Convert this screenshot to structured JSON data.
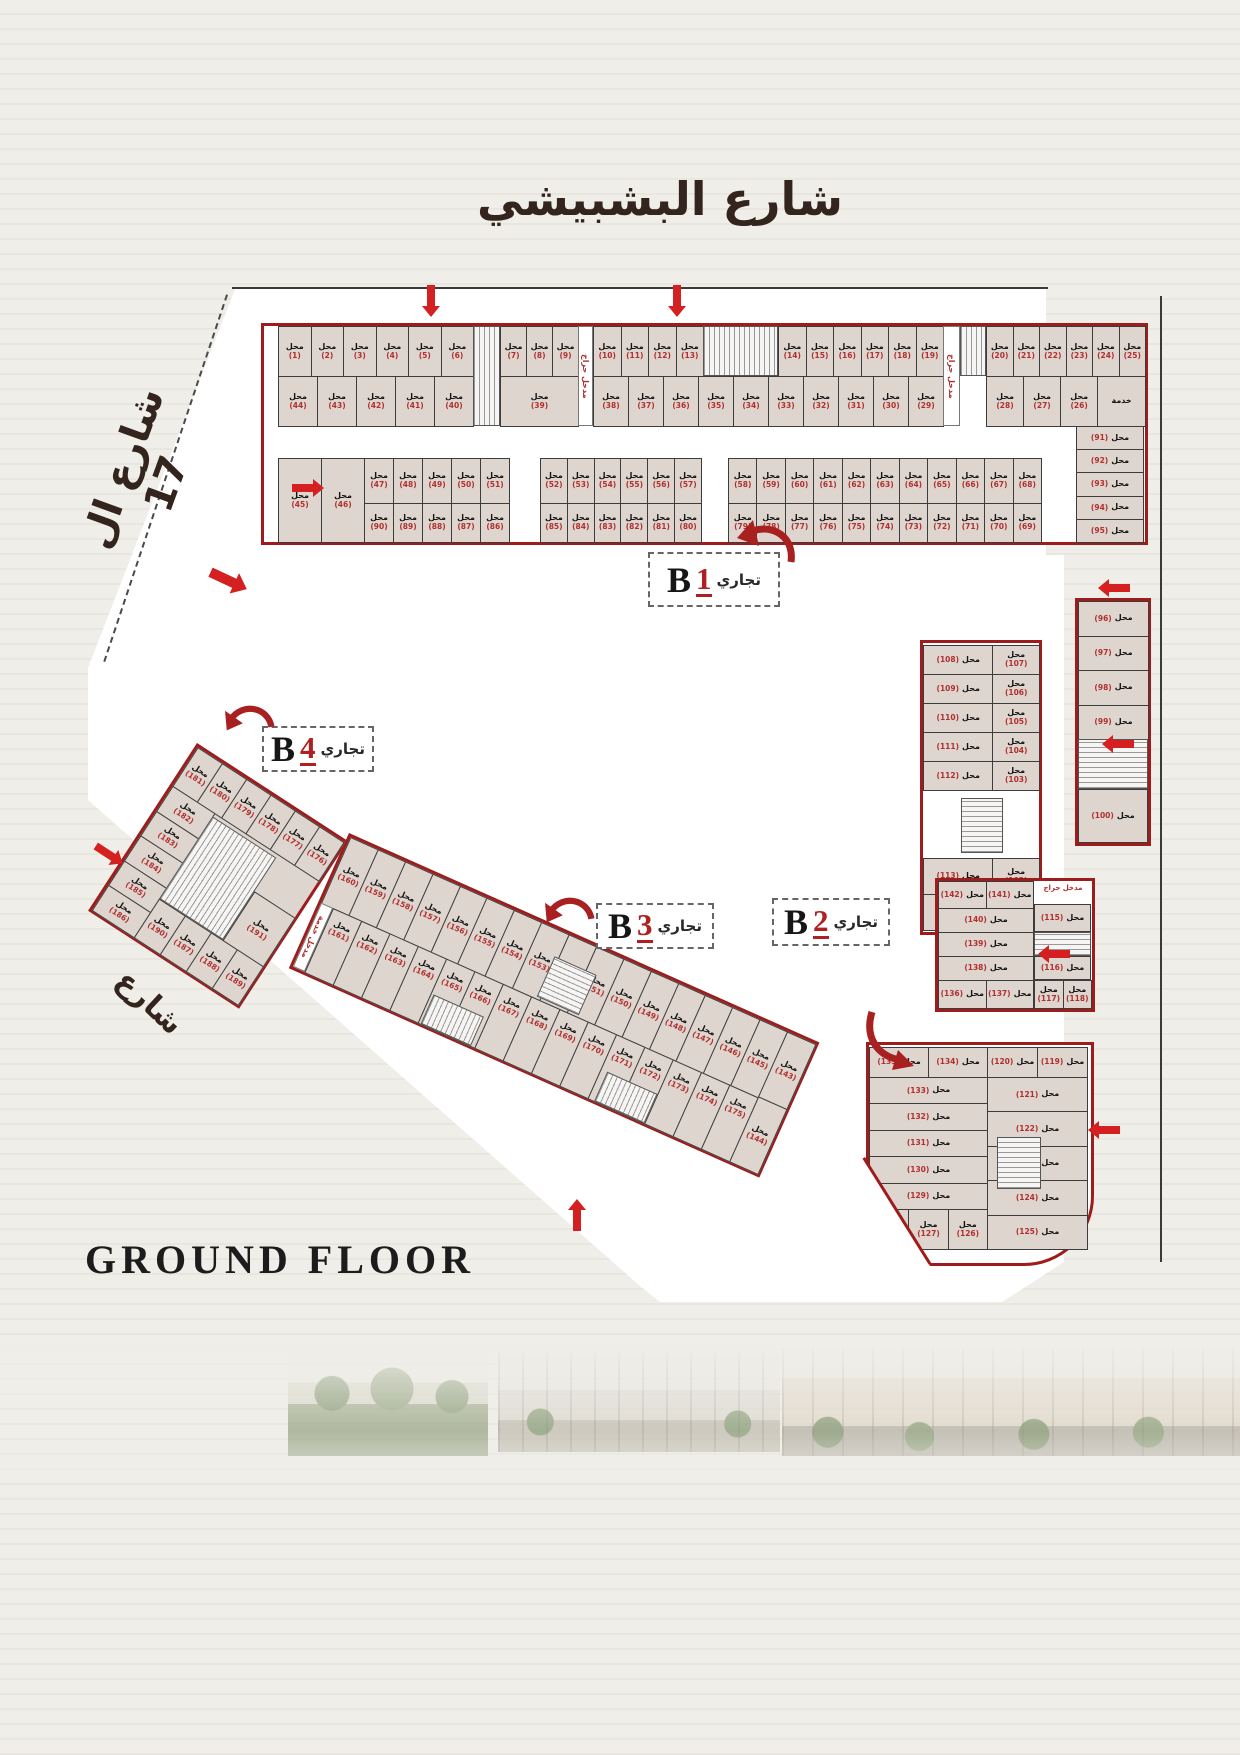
{
  "labels": {
    "shop": "محل",
    "service": "خدمة",
    "commercial": "تجاري",
    "ground_floor": "GROUND FLOOR"
  },
  "streets": {
    "top": "شارع  البشبيشي",
    "left": "شارع ال 17",
    "left_lower": "شارع",
    "right": "شارع"
  },
  "entrances": {
    "garage": "مدخل جراج",
    "service_entrance": "مدخل خدمة"
  },
  "blocks": {
    "b1": {
      "letter": "B",
      "number": "1",
      "a1": [
        "(1)",
        "(2)",
        "(3)",
        "(4)",
        "(5)",
        "(6)"
      ],
      "a2": [
        "(7)",
        "(8)",
        "(9)"
      ],
      "a3": [
        "(10)",
        "(11)",
        "(12)",
        "(13)"
      ],
      "a4": [
        "(14)",
        "(15)",
        "(16)",
        "(17)",
        "(18)",
        "(19)"
      ],
      "a5": [
        "(20)",
        "(21)",
        "(22)",
        "(23)",
        "(24)",
        "(25)"
      ],
      "bb1": [
        "(44)",
        "(43)",
        "(42)",
        "(41)",
        "(40)"
      ],
      "bb2": [
        "(39)"
      ],
      "bb3": [
        "(38)",
        "(37)",
        "(36)",
        "(35)",
        "(34)",
        "(33)",
        "(32)",
        "(31)",
        "(30)",
        "(29)"
      ],
      "bb4": [
        "(28)",
        "(27)",
        "(26)"
      ],
      "c1": [
        "(45)",
        "(46)"
      ],
      "c2": [
        "(47)",
        "(48)",
        "(49)",
        "(50)",
        "(51)"
      ],
      "c3": [
        "(52)",
        "(53)",
        "(54)",
        "(55)",
        "(56)",
        "(57)"
      ],
      "c4": [
        "(58)",
        "(59)",
        "(60)",
        "(61)",
        "(62)",
        "(63)",
        "(64)",
        "(65)",
        "(66)",
        "(67)",
        "(68)"
      ],
      "d1": [
        "(90)",
        "(89)",
        "(88)",
        "(87)",
        "(86)"
      ],
      "d2": [
        "(85)",
        "(84)",
        "(83)",
        "(82)",
        "(81)",
        "(80)"
      ],
      "d3": [
        "(79)",
        "(78)",
        "(77)",
        "(76)",
        "(75)",
        "(74)",
        "(73)",
        "(72)",
        "(71)",
        "(70)",
        "(69)"
      ],
      "col91": [
        "(91)",
        "(92)",
        "(93)",
        "(94)",
        "(95)"
      ],
      "col96": [
        "(96)",
        "(97)",
        "(98)",
        "(99)"
      ],
      "cell100": "(100)",
      "mr1": [
        [
          "(108)",
          "(107)"
        ],
        [
          "(109)",
          "(106)"
        ],
        [
          "(110)",
          "(105)"
        ],
        [
          "(111)",
          "(104)"
        ],
        [
          "(112)",
          "(103)"
        ]
      ],
      "mr2": [
        [
          "(113)",
          "(102)"
        ],
        [
          "(114)",
          "(101)"
        ]
      ]
    },
    "b2": {
      "letter": "B",
      "number": "2",
      "t_left_pair": [
        [
          "(142)",
          "(141)"
        ]
      ],
      "t_left_singles": [
        "(140)",
        "(139)",
        "(138)"
      ],
      "t_left_pair2": [
        [
          "(136)",
          "(137)"
        ]
      ],
      "t_right_single1": "(115)",
      "t_right_single2": "(116)",
      "t_right_pair": [
        [
          "(117)",
          "(118)"
        ]
      ],
      "b_left_pair": [
        [
          "(135)",
          "(134)"
        ]
      ],
      "b_left_singles": [
        "(133)",
        "(132)",
        "(131)",
        "(130)",
        "(129)"
      ],
      "b_left_bottom": [
        "(128)",
        "(127)",
        "(126)"
      ],
      "b_right_pair": [
        [
          "(120)",
          "(119)"
        ]
      ],
      "b_right_singles": [
        "(121)",
        "(122)",
        "(123)",
        "(124)",
        "(125)"
      ]
    },
    "b3": {
      "letter": "B",
      "number": "3",
      "row1": [
        "(160)",
        "(159)",
        "(158)",
        "(157)",
        "(156)",
        "(155)",
        "(154)",
        "(153)",
        "(152)",
        "(151)",
        "(150)",
        "(149)",
        "(148)",
        "(147)",
        "(146)",
        "(145)"
      ],
      "end_col": [
        "(143)",
        "(144)"
      ],
      "row2": [
        "(161)",
        "(162)",
        "(163)",
        "(164)",
        "(165)",
        "(166)",
        "(167)",
        "(168)",
        "(169)",
        "(170)",
        "(171)",
        "(172)",
        "(173)",
        "(174)",
        "(175)"
      ]
    },
    "b4": {
      "letter": "B",
      "number": "4",
      "top": [
        "(181)",
        "(180)",
        "(179)",
        "(178)",
        "(177)",
        "(176)"
      ],
      "left": [
        "(182)",
        "(183)",
        "(184)",
        "(185)",
        "(186)"
      ],
      "mid_right": [
        "(191)"
      ],
      "bottom": [
        "(190)",
        "(187)",
        "(188)",
        "(189)"
      ]
    }
  }
}
